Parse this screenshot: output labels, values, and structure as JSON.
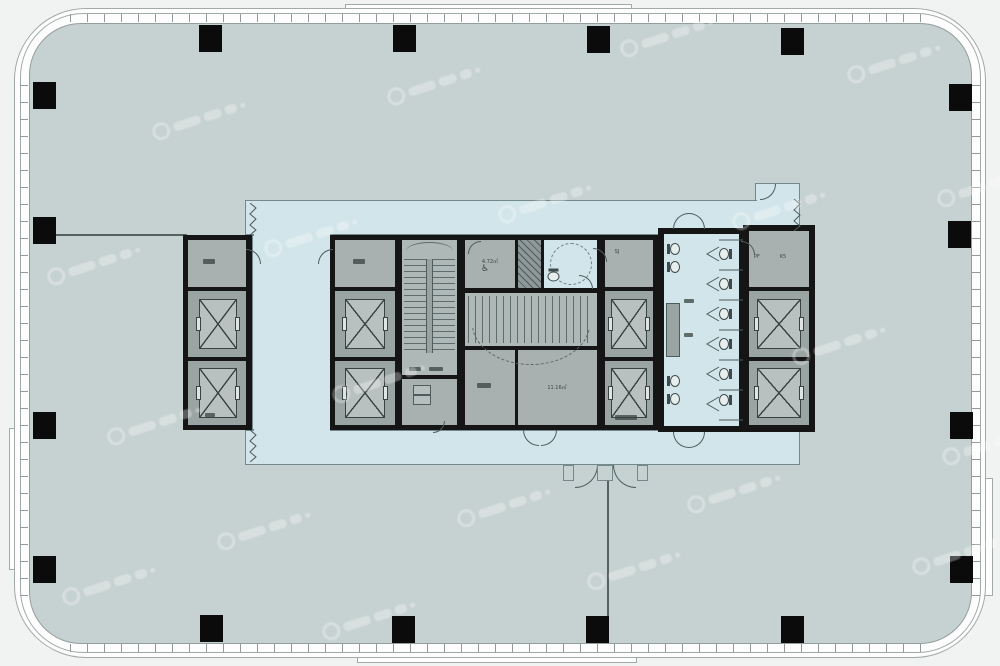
{
  "page": {
    "type": "architectural-floor-plan",
    "subject": "High-rise office tower typical floor plan with central service core, elevator banks, stairs and washrooms"
  },
  "colors": {
    "page_bg": "#f1f2f2",
    "building_fill": "#fdfdfd",
    "outline": "#a2a9a9",
    "tick": "#8f9999",
    "floor": "#c6d2d1",
    "floor_edge": "#939d9d",
    "corridor": "#d2e5ea",
    "corridor_edge": "#75898c",
    "wall": "#141514",
    "room_light": "#a8b1b0",
    "room_dark": "#9aa4a3",
    "stair": "#aeb8b6",
    "duct": "#8e9898",
    "detail_line": "#4e5c5c",
    "elevator_cab": "#b9c1c0",
    "column": "#0b0b0b"
  },
  "core": {
    "labels": {
      "room_sj": "SJ",
      "room_pf": "PF",
      "room_k5": "K5",
      "area_small": "4.72㎡",
      "area_large": "11.16㎡"
    },
    "features": {
      "elevator_count": 10,
      "stair_count": 2,
      "toilet_stall_count": 6,
      "wall_toilet_count": 4,
      "accessible_wc": true
    }
  },
  "structure": {
    "perimeter_column_count": 16
  },
  "watermark": {
    "present": true,
    "style": "repeated diagonal logo",
    "opacity": 0.3
  }
}
